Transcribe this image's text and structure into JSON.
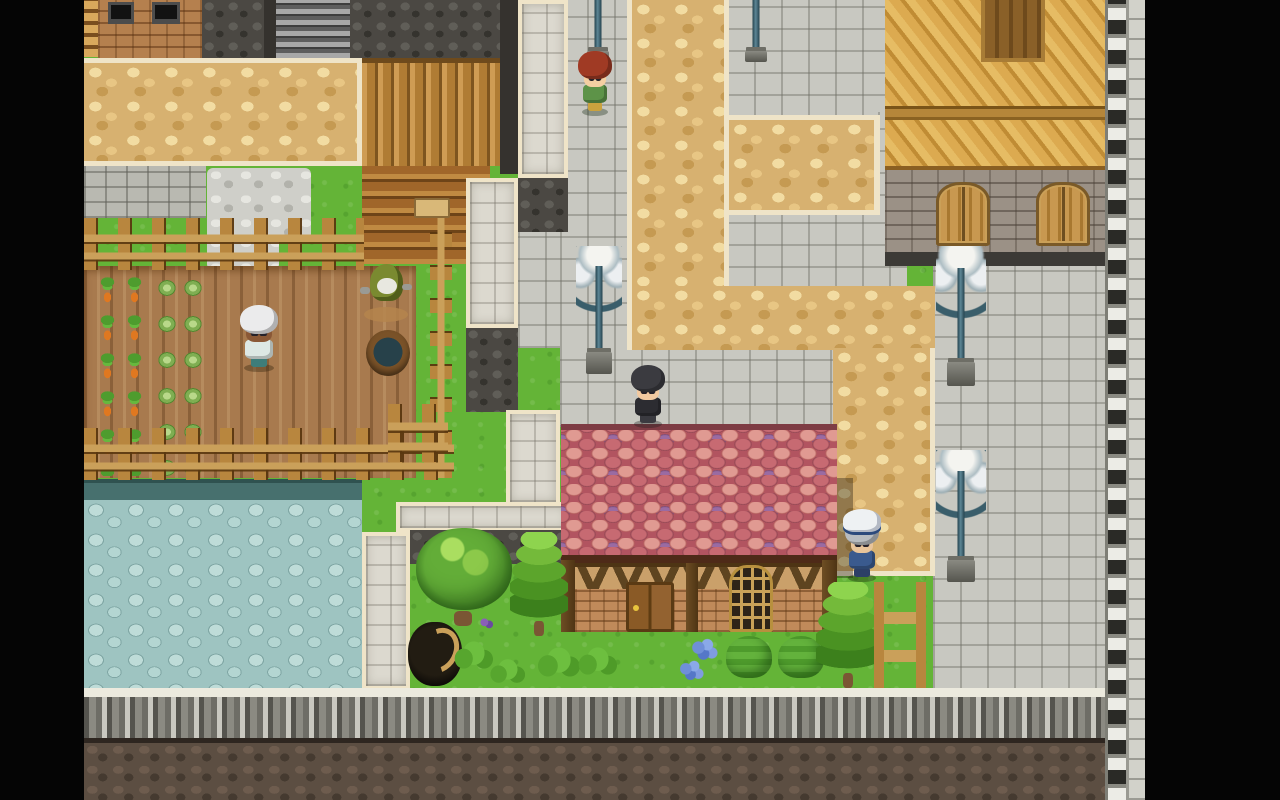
{
  "meta": {
    "description": "Top-down 2D RPG village scene (RPG Maker style), letterboxed with black side bars",
    "viewport": "1280x800",
    "visible_text": []
  },
  "palette": {
    "grass": "#64b437",
    "soil": "#a87a4e",
    "carrot": "#e07820",
    "tan": "#d7b170",
    "cream": "#efe4c8",
    "plaza": "#c8c8c1",
    "pond": "#9ec4c1",
    "dcobble": "#4b4843",
    "bcobble": "#5c4e42",
    "wwall": "#dcd9cf",
    "wood1": "#b8863e",
    "wood2": "#caa05a",
    "lamp": "#5d8695",
    "letterbox": "#050505"
  },
  "elements": [
    {
      "type": "grass",
      "name": "grass-base",
      "x": 84,
      "y": 0,
      "w": 1061,
      "h": 745,
      "interactable": false
    },
    {
      "type": "pond-edge",
      "name": "pond-north-edge",
      "x": 84,
      "y": 479,
      "w": 278,
      "h": 24,
      "interactable": false
    },
    {
      "type": "pond",
      "name": "pebble-pond",
      "x": 84,
      "y": 500,
      "w": 278,
      "h": 190,
      "interactable": false
    },
    {
      "type": "gbrick",
      "name": "gray-brick-pavement",
      "x": 84,
      "y": 166,
      "w": 122,
      "h": 52,
      "interactable": false
    },
    {
      "type": "gravel",
      "name": "gravel-patch",
      "x": 207,
      "y": 168,
      "w": 104,
      "h": 72,
      "interactable": false
    },
    {
      "type": "gravel",
      "name": "gravel-patch-lower",
      "x": 207,
      "y": 236,
      "w": 72,
      "h": 34,
      "interactable": false
    },
    {
      "type": "soil",
      "name": "farm-field",
      "x": 84,
      "y": 266,
      "w": 332,
      "h": 212,
      "interactable": false
    },
    {
      "type": "carrots",
      "name": "carrot-rows",
      "x": 94,
      "y": 270,
      "w": 58,
      "h": 206,
      "interactable": false
    },
    {
      "type": "cabbages",
      "name": "cabbage-rows",
      "x": 154,
      "y": 270,
      "w": 52,
      "h": 206,
      "interactable": false
    },
    {
      "type": "gplaza",
      "name": "plaza-west-lower",
      "x": 518,
      "y": 228,
      "w": 110,
      "h": 120,
      "interactable": false
    },
    {
      "type": "gplaza",
      "name": "plaza-west-strip",
      "x": 560,
      "y": 0,
      "w": 68,
      "h": 348,
      "interactable": false
    },
    {
      "type": "gplaza",
      "name": "plaza-north-pocket",
      "x": 727,
      "y": 0,
      "w": 180,
      "h": 118,
      "interactable": false
    },
    {
      "type": "gplaza",
      "name": "plaza-east-gap",
      "x": 878,
      "y": 112,
      "w": 30,
      "h": 106,
      "interactable": false
    },
    {
      "type": "gplaza",
      "name": "plaza-mid-pocket",
      "x": 727,
      "y": 212,
      "w": 180,
      "h": 78,
      "interactable": false
    },
    {
      "type": "gplaza",
      "name": "sidewalk-above-house",
      "x": 560,
      "y": 345,
      "w": 278,
      "h": 82,
      "interactable": false
    },
    {
      "type": "gplaza",
      "name": "plaza-east-main",
      "x": 933,
      "y": 263,
      "w": 174,
      "h": 427,
      "interactable": false
    },
    {
      "type": "tan tan-vpath",
      "name": "cobble-path-vertical",
      "x": 627,
      "y": 0,
      "w": 102,
      "h": 290,
      "interactable": false
    },
    {
      "type": "tan tan-branch",
      "name": "cobble-path-branch",
      "x": 729,
      "y": 115,
      "w": 151,
      "h": 100,
      "interactable": false
    },
    {
      "type": "tan tan-plaza",
      "name": "cobble-plaza",
      "x": 627,
      "y": 286,
      "w": 308,
      "h": 64,
      "interactable": false
    },
    {
      "type": "tan tan-strip",
      "name": "cobble-path-house-side",
      "x": 833,
      "y": 348,
      "w": 102,
      "h": 228,
      "interactable": false
    },
    {
      "type": "dcobble",
      "name": "dark-wall-a",
      "x": 202,
      "y": 0,
      "w": 62,
      "h": 58,
      "interactable": false
    },
    {
      "type": "dstrip",
      "name": "dark-strip-a",
      "x": 264,
      "y": 0,
      "w": 12,
      "h": 58,
      "interactable": false
    },
    {
      "type": "corrug",
      "name": "corrugated-roof",
      "x": 276,
      "y": 0,
      "w": 74,
      "h": 58,
      "interactable": false
    },
    {
      "type": "dcobble",
      "name": "dark-wall-b",
      "x": 350,
      "y": 0,
      "w": 150,
      "h": 58,
      "interactable": false
    },
    {
      "type": "dstrip",
      "name": "dark-strip-b",
      "x": 500,
      "y": 0,
      "w": 18,
      "h": 174,
      "interactable": false
    },
    {
      "type": "wlad",
      "name": "wood-ladder-strip",
      "x": 84,
      "y": 0,
      "w": 14,
      "h": 57,
      "interactable": false
    },
    {
      "type": "bbrick",
      "name": "brick-building",
      "x": 98,
      "y": 0,
      "w": 104,
      "h": 60,
      "interactable": false
    },
    {
      "type": "winDark",
      "name": "dark-window",
      "x": 108,
      "y": 2,
      "w": 26,
      "h": 22,
      "interactable": false
    },
    {
      "type": "winDark",
      "name": "dark-window",
      "x": 152,
      "y": 2,
      "w": 28,
      "h": 22,
      "interactable": false
    },
    {
      "type": "tan tan-top",
      "name": "cobble-path-top-band",
      "x": 84,
      "y": 58,
      "w": 278,
      "h": 108,
      "interactable": false
    },
    {
      "type": "logsV",
      "name": "log-wall-vertical",
      "x": 362,
      "y": 58,
      "w": 138,
      "h": 108,
      "interactable": false
    },
    {
      "type": "logsH",
      "name": "log-wall-horizontal",
      "x": 362,
      "y": 166,
      "w": 128,
      "h": 98,
      "interactable": false
    },
    {
      "type": "sign",
      "name": "wall-sign",
      "x": 414,
      "y": 198,
      "w": 36,
      "h": 20,
      "interactable": false
    },
    {
      "type": "wwall",
      "name": "rampart-segment-north",
      "x": 518,
      "y": 0,
      "w": 50,
      "h": 178,
      "interactable": false
    },
    {
      "type": "dcobble",
      "name": "dark-pocket-a",
      "x": 518,
      "y": 178,
      "w": 50,
      "h": 54,
      "interactable": false
    },
    {
      "type": "wwall",
      "name": "rampart-segment-mid",
      "x": 466,
      "y": 178,
      "w": 52,
      "h": 150,
      "interactable": false
    },
    {
      "type": "dcobble",
      "name": "dark-pocket-b",
      "x": 466,
      "y": 328,
      "w": 52,
      "h": 84,
      "interactable": false
    },
    {
      "type": "wwall",
      "name": "rampart-segment-low",
      "x": 506,
      "y": 410,
      "w": 54,
      "h": 96,
      "interactable": false
    },
    {
      "type": "wwall",
      "name": "rampart-segment-horizontal",
      "x": 396,
      "y": 502,
      "w": 174,
      "h": 30,
      "interactable": false
    },
    {
      "type": "wwall",
      "name": "rampart-segment-south",
      "x": 362,
      "y": 532,
      "w": 48,
      "h": 158,
      "interactable": false
    },
    {
      "type": "dcobble",
      "name": "garden-back-wall",
      "x": 410,
      "y": 530,
      "w": 158,
      "h": 34,
      "interactable": false
    },
    {
      "type": "fenceH",
      "name": "farm-fence-north",
      "x": 84,
      "y": 218,
      "w": 280,
      "h": 52,
      "interactable": false
    },
    {
      "type": "fenceV",
      "name": "farm-fence-east",
      "x": 430,
      "y": 218,
      "w": 22,
      "h": 260,
      "interactable": false
    },
    {
      "type": "fenceH",
      "name": "farm-fence-south",
      "x": 84,
      "y": 428,
      "w": 370,
      "h": 52,
      "interactable": false
    },
    {
      "type": "fenceH",
      "name": "garden-fence-small",
      "x": 388,
      "y": 404,
      "w": 60,
      "h": 58,
      "interactable": false
    },
    {
      "type": "roofWood",
      "name": "east-building-roof",
      "x": 885,
      "y": 0,
      "w": 222,
      "h": 170,
      "interactable": false
    },
    {
      "type": "dormer",
      "name": "east-building-dormer",
      "x": 981,
      "y": 0,
      "w": 64,
      "h": 62,
      "interactable": false
    },
    {
      "type": "eaveBand",
      "name": "east-building-eave",
      "x": 885,
      "y": 106,
      "w": 222,
      "h": 14,
      "interactable": false
    },
    {
      "type": "sbrick",
      "name": "east-building-wall",
      "x": 885,
      "y": 170,
      "w": 222,
      "h": 84,
      "interactable": false
    },
    {
      "type": "dfooter",
      "name": "east-building-footer",
      "x": 885,
      "y": 252,
      "w": 222,
      "h": 14,
      "interactable": false
    },
    {
      "type": "shutter",
      "name": "shuttered-window",
      "x": 936,
      "y": 182,
      "w": 54,
      "h": 64,
      "interactable": false
    },
    {
      "type": "shutter",
      "name": "shuttered-window",
      "x": 1036,
      "y": 182,
      "w": 54,
      "h": 64,
      "interactable": false
    },
    {
      "type": "shadowR",
      "name": "house-cast-shadow",
      "x": 833,
      "y": 478,
      "w": 20,
      "h": 100,
      "interactable": false
    },
    {
      "type": "ridge",
      "name": "house-roof-ridge",
      "x": 561,
      "y": 424,
      "w": 276,
      "h": 8,
      "interactable": false
    },
    {
      "type": "shingles",
      "name": "house-roof-shingles",
      "x": 561,
      "y": 430,
      "w": 276,
      "h": 128,
      "interactable": false
    },
    {
      "type": "heave",
      "name": "house-eave",
      "x": 561,
      "y": 555,
      "w": 276,
      "h": 10,
      "interactable": false
    },
    {
      "type": "hwall",
      "name": "house-wall",
      "x": 561,
      "y": 563,
      "w": 276,
      "h": 69,
      "interactable": false
    },
    {
      "type": "timberBand",
      "name": "house-timber-band",
      "x": 561,
      "y": 563,
      "w": 276,
      "h": 26,
      "interactable": false
    },
    {
      "type": "tpost",
      "name": "house-post-left",
      "x": 561,
      "y": 560,
      "w": 14,
      "h": 72,
      "interactable": false
    },
    {
      "type": "tpost",
      "name": "house-post-mid",
      "x": 686,
      "y": 563,
      "w": 12,
      "h": 69,
      "interactable": false
    },
    {
      "type": "tpost",
      "name": "house-post-right",
      "x": 822,
      "y": 560,
      "w": 15,
      "h": 72,
      "interactable": false
    },
    {
      "type": "hdoor",
      "name": "house-door",
      "x": 626,
      "y": 582,
      "w": 48,
      "h": 50,
      "interactable": true
    },
    {
      "type": "hwindow",
      "name": "house-window",
      "x": 729,
      "y": 565,
      "w": 44,
      "h": 67,
      "interactable": false
    },
    {
      "type": "treeR",
      "name": "round-tree",
      "x": 416,
      "y": 528,
      "w": 96,
      "h": 102,
      "interactable": false
    },
    {
      "type": "treeC",
      "name": "conifer-tree",
      "x": 510,
      "y": 532,
      "w": 58,
      "h": 104,
      "interactable": false
    },
    {
      "type": "stump",
      "name": "dark-stump-roots",
      "x": 408,
      "y": 622,
      "w": 54,
      "h": 64,
      "interactable": false
    },
    {
      "type": "tuft",
      "name": "grass-tuft",
      "x": 452,
      "y": 640,
      "w": 42,
      "h": 30,
      "interactable": false
    },
    {
      "type": "tuft",
      "name": "grass-tuft",
      "x": 488,
      "y": 658,
      "w": 38,
      "h": 26,
      "interactable": false
    },
    {
      "type": "tuft",
      "name": "grass-tuft",
      "x": 535,
      "y": 646,
      "w": 46,
      "h": 32,
      "interactable": false
    },
    {
      "type": "tuft",
      "name": "grass-tuft",
      "x": 576,
      "y": 646,
      "w": 42,
      "h": 30,
      "interactable": false
    },
    {
      "type": "flP",
      "name": "purple-flowers",
      "x": 478,
      "y": 616,
      "w": 16,
      "h": 14,
      "interactable": false
    },
    {
      "type": "flB",
      "name": "blue-flowers",
      "x": 690,
      "y": 638,
      "w": 28,
      "h": 24,
      "interactable": false
    },
    {
      "type": "flB",
      "name": "blue-flowers",
      "x": 678,
      "y": 660,
      "w": 26,
      "h": 22,
      "interactable": false
    },
    {
      "type": "bush",
      "name": "trimmed-bush",
      "x": 726,
      "y": 636,
      "w": 46,
      "h": 42,
      "interactable": false
    },
    {
      "type": "bush",
      "name": "trimmed-bush",
      "x": 778,
      "y": 636,
      "w": 46,
      "h": 42,
      "interactable": false
    },
    {
      "type": "treeC",
      "name": "conifer-tree",
      "x": 816,
      "y": 582,
      "w": 64,
      "h": 106,
      "interactable": false
    },
    {
      "type": "fenceC",
      "name": "garden-fence-corner",
      "x": 874,
      "y": 582,
      "w": 52,
      "h": 106,
      "interactable": false
    },
    {
      "type": "scarecrow",
      "name": "scarecrow",
      "x": 362,
      "y": 264,
      "w": 48,
      "h": 58,
      "interactable": false,
      "parts": [
        {
          "cls": "s-mound",
          "color": "#b5854e"
        },
        {
          "cls": "s-hood",
          "color": "#7a8a30"
        },
        {
          "cls": "s-face",
          "color": "#e8e8e0"
        },
        {
          "cls": "s-armL",
          "color": "#9a9a94"
        },
        {
          "cls": "s-armR",
          "color": "#9a9a94"
        }
      ]
    },
    {
      "type": "tub",
      "name": "water-tub",
      "x": 366,
      "y": 330,
      "w": 44,
      "h": 46,
      "interactable": false
    },
    {
      "type": "lampP",
      "name": "street-lamp-pole",
      "x": 578,
      "y": 0,
      "w": 40,
      "h": 62,
      "interactable": false
    },
    {
      "type": "lampP",
      "name": "street-lamp-pole",
      "x": 736,
      "y": 0,
      "w": 40,
      "h": 62,
      "interactable": false
    },
    {
      "type": "lampF",
      "name": "street-lamp",
      "x": 576,
      "y": 246,
      "w": 46,
      "h": 128,
      "interactable": false
    },
    {
      "type": "lampF",
      "name": "street-lamp",
      "x": 936,
      "y": 246,
      "w": 50,
      "h": 140,
      "interactable": false
    },
    {
      "type": "lampF",
      "name": "street-lamp",
      "x": 936,
      "y": 450,
      "w": 50,
      "h": 132,
      "interactable": false
    },
    {
      "type": "chara",
      "name": "npc-redhead-villager",
      "x": 577,
      "y": 52,
      "w": 36,
      "h": 62,
      "interactable": true,
      "parts": [
        {
          "cls": "c-shadow",
          "color": "rgba(20,40,16,.35)"
        },
        {
          "cls": "c-legs",
          "color": "#caa23e"
        },
        {
          "cls": "c-body",
          "color": "#5d9348"
        },
        {
          "cls": "c-face",
          "color": "#f4cfa2"
        },
        {
          "cls": "c-hair",
          "color": "#a03a24"
        }
      ]
    },
    {
      "type": "chara",
      "name": "npc-whitehair-farmer",
      "x": 238,
      "y": 306,
      "w": 42,
      "h": 64,
      "interactable": true,
      "parts": [
        {
          "cls": "c-shadow",
          "color": "rgba(40,30,10,.35)"
        },
        {
          "cls": "c-legs",
          "color": "#3e7d7a"
        },
        {
          "cls": "c-body",
          "color": "#dde8e4"
        },
        {
          "cls": "c-face",
          "color": "#8a5836"
        },
        {
          "cls": "c-hair",
          "color": "#ebebec"
        }
      ]
    },
    {
      "type": "chara",
      "name": "player-blackhair",
      "x": 629,
      "y": 366,
      "w": 38,
      "h": 60,
      "interactable": true,
      "parts": [
        {
          "cls": "c-shadow",
          "color": "rgba(30,30,30,.35)"
        },
        {
          "cls": "c-legs",
          "color": "#3a3a40"
        },
        {
          "cls": "c-body",
          "color": "#2c2c31"
        },
        {
          "cls": "c-face",
          "color": "#f2c9a0"
        },
        {
          "cls": "c-hair",
          "color": "#3b3b40"
        }
      ]
    },
    {
      "type": "chara",
      "name": "npc-sailor-captain",
      "x": 843,
      "y": 518,
      "w": 38,
      "h": 62,
      "interactable": true,
      "parts": [
        {
          "cls": "c-shadow",
          "color": "rgba(20,30,10,.35)"
        },
        {
          "cls": "c-legs",
          "color": "#2c3f66"
        },
        {
          "cls": "c-body",
          "color": "#3a5a8e"
        },
        {
          "cls": "c-face",
          "color": "#e8c49a"
        },
        {
          "cls": "c-hair",
          "color": "#b8bcc0"
        },
        {
          "cls": "c-hat",
          "color": "#eef1f3"
        }
      ]
    },
    {
      "type": "battle",
      "name": "south-battlement-wall",
      "x": 84,
      "y": 688,
      "w": 1061,
      "h": 54,
      "interactable": false
    },
    {
      "type": "bcobble",
      "name": "south-cobble-base",
      "x": 84,
      "y": 738,
      "w": 1061,
      "h": 62,
      "interactable": false
    },
    {
      "type": "ladcol",
      "name": "east-edge-wall-column",
      "x": 1105,
      "y": 0,
      "w": 24,
      "h": 800,
      "interactable": false
    },
    {
      "type": "litecol",
      "name": "east-edge-light-column",
      "x": 1129,
      "y": 0,
      "w": 16,
      "h": 800,
      "interactable": false
    },
    {
      "type": "letterbox",
      "name": "letterbox-left",
      "x": 0,
      "y": 0,
      "w": 84,
      "h": 800,
      "interactable": false
    },
    {
      "type": "letterbox",
      "name": "letterbox-right",
      "x": 1145,
      "y": 0,
      "w": 135,
      "h": 800,
      "interactable": false
    }
  ]
}
